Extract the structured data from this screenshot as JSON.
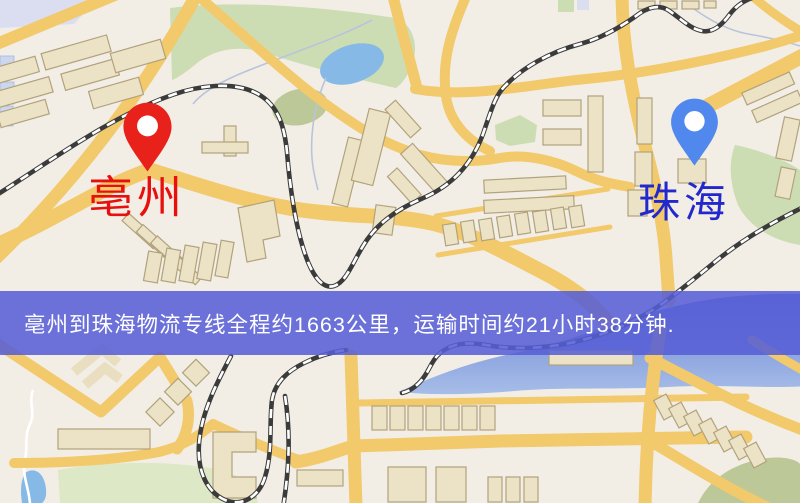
{
  "theme": {
    "map_bg": "#f2eee6",
    "road_color": "#f2c96b",
    "building_fill": "#ece3c6",
    "building_edge": "#b2a27c",
    "green_color": "#cdddb3",
    "water_color": "#86b9e6",
    "rail_color": "#3b3b3b",
    "banner_bg": "#565ed6",
    "banner_text_color": "#ffffff",
    "origin_pin_color": "#e8211a",
    "origin_label_color": "#e8100c",
    "destination_pin_color": "#5088ee",
    "destination_label_color": "#2328cd"
  },
  "map": {
    "origin": {
      "label": "亳州",
      "marker": "red-pin"
    },
    "destination": {
      "label": "珠海",
      "marker": "blue-pin"
    }
  },
  "banner": {
    "text": "亳州到珠海物流专线全程约1663公里，运输时间约21小时38分钟.",
    "route": {
      "from": "亳州",
      "to": "珠海",
      "distance_text": "约1663公里",
      "duration_text": "约21小时38分钟"
    }
  }
}
